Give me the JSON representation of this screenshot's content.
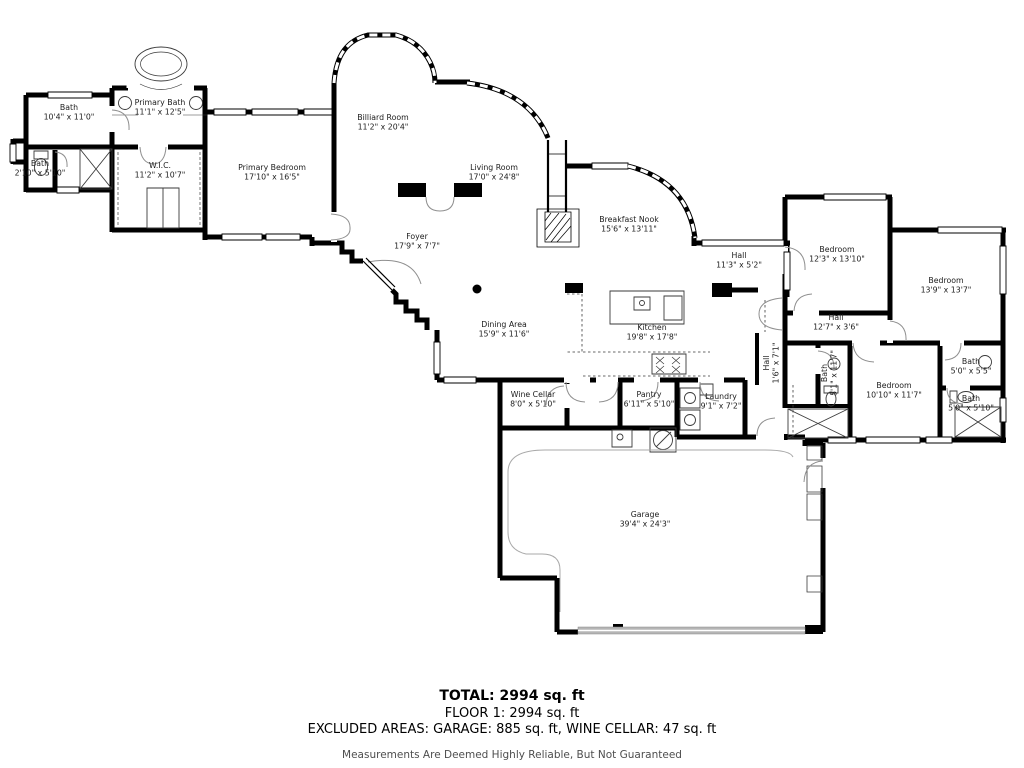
{
  "floor_plan": {
    "rooms": [
      {
        "name": "Bath",
        "dims": "10'4\" x 11'0\"",
        "x": 69,
        "y": 110,
        "rotate": 0
      },
      {
        "name": "Primary Bath",
        "dims": "11'1\" x 12'5\"",
        "x": 160,
        "y": 105,
        "rotate": 0
      },
      {
        "name": "Bath",
        "dims": "2'10\" x 5'10\"",
        "x": 40,
        "y": 166,
        "rotate": 0
      },
      {
        "name": "W.I.C.",
        "dims": "11'2\" x 10'7\"",
        "x": 160,
        "y": 168,
        "rotate": 0
      },
      {
        "name": "Primary Bedroom",
        "dims": "17'10\" x 16'5\"",
        "x": 272,
        "y": 170,
        "rotate": 0
      },
      {
        "name": "Billiard Room",
        "dims": "11'2\" x 20'4\"",
        "x": 383,
        "y": 120,
        "rotate": 0
      },
      {
        "name": "Living Room",
        "dims": "17'0\" x 24'8\"",
        "x": 494,
        "y": 170,
        "rotate": 0
      },
      {
        "name": "Foyer",
        "dims": "17'9\" x 7'7\"",
        "x": 417,
        "y": 239,
        "rotate": 0
      },
      {
        "name": "Breakfast Nook",
        "dims": "15'6\" x 13'11\"",
        "x": 629,
        "y": 222,
        "rotate": 0
      },
      {
        "name": "Hall",
        "dims": "11'3\" x 5'2\"",
        "x": 739,
        "y": 258,
        "rotate": 0
      },
      {
        "name": "Bedroom",
        "dims": "12'3\" x 13'10\"",
        "x": 837,
        "y": 252,
        "rotate": 0
      },
      {
        "name": "Bedroom",
        "dims": "13'9\" x 13'7\"",
        "x": 946,
        "y": 283,
        "rotate": 0
      },
      {
        "name": "Hall",
        "dims": "12'7\" x 3'6\"",
        "x": 836,
        "y": 320,
        "rotate": 0
      },
      {
        "name": "Dining Area",
        "dims": "15'9\" x 11'6\"",
        "x": 504,
        "y": 327,
        "rotate": 0
      },
      {
        "name": "Kitchen",
        "dims": "19'8\" x 17'8\"",
        "x": 652,
        "y": 330,
        "rotate": 0
      },
      {
        "name": "Wine Cellar",
        "dims": "8'0\" x 5'10\"",
        "x": 533,
        "y": 397,
        "rotate": 0
      },
      {
        "name": "Pantry",
        "dims": "6'11\" x 5'10\"",
        "x": 649,
        "y": 397,
        "rotate": 0
      },
      {
        "name": "Laundry",
        "dims": "9'1\" x 7'2\"",
        "x": 721,
        "y": 399,
        "rotate": 0
      },
      {
        "name": "Hall",
        "dims": "1'6\" x 7'1\"",
        "x": 769,
        "y": 363,
        "rotate": -90
      },
      {
        "name": "Bath",
        "dims": "5'1\" x 11'7\"",
        "x": 827,
        "y": 373,
        "rotate": -90
      },
      {
        "name": "Bedroom",
        "dims": "10'10\" x 11'7\"",
        "x": 894,
        "y": 388,
        "rotate": 0
      },
      {
        "name": "Bath",
        "dims": "5'0\" x 5'5\"",
        "x": 971,
        "y": 364,
        "rotate": 0
      },
      {
        "name": "Bath",
        "dims": "5'0\" x 5'10\"",
        "x": 971,
        "y": 401,
        "rotate": 0
      },
      {
        "name": "Garage",
        "dims": "39'4\" x 24'3\"",
        "x": 645,
        "y": 517,
        "rotate": 0
      }
    ],
    "summary": {
      "total": "TOTAL: 2994 sq. ft",
      "floor": "FLOOR 1: 2994 sq. ft",
      "excluded": "EXCLUDED AREAS: GARAGE: 885 sq. ft, WINE CELLAR: 47 sq. ft",
      "disclaimer": "Measurements Are Deemed Highly Reliable, But Not Guaranteed"
    }
  }
}
